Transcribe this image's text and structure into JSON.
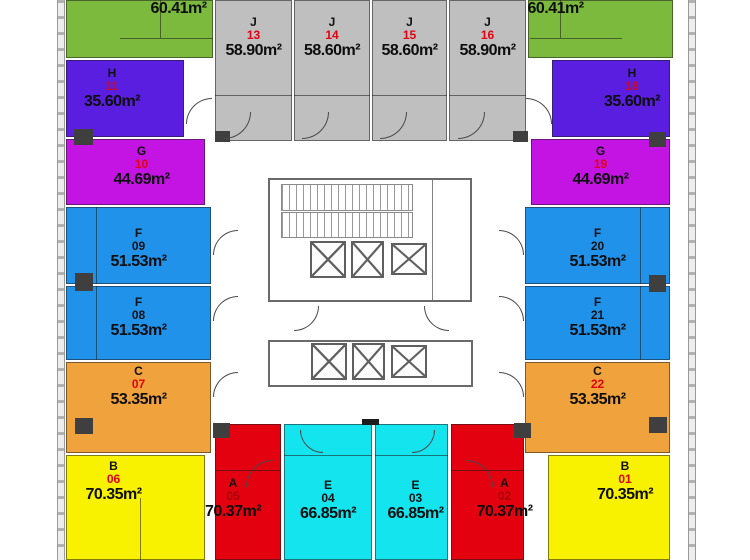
{
  "palette": {
    "green": "#7cba3d",
    "gray": "#bfbfbf",
    "purple": "#5a1ee0",
    "magenta": "#c414e4",
    "blue": "#2192ea",
    "orange": "#f0a23c",
    "yellow": "#f8f200",
    "red": "#e3000f",
    "cyan": "#14e4ee",
    "wall": "#5a5a5a",
    "shaft": "#3f3f3f"
  },
  "units": {
    "u12": {
      "letter": "",
      "number": "12",
      "area": "60.41m²",
      "color": "#7cba3d",
      "num_color": "#e30010"
    },
    "j13": {
      "letter": "J",
      "number": "13",
      "area": "58.90m²",
      "color": "#bfbfbf",
      "num_color": "#e30010"
    },
    "j14": {
      "letter": "J",
      "number": "14",
      "area": "58.60m²",
      "color": "#bfbfbf",
      "num_color": "#e30010"
    },
    "j15": {
      "letter": "J",
      "number": "15",
      "area": "58.60m²",
      "color": "#bfbfbf",
      "num_color": "#e30010"
    },
    "j16": {
      "letter": "J",
      "number": "16",
      "area": "58.90m²",
      "color": "#bfbfbf",
      "num_color": "#e30010"
    },
    "u17": {
      "letter": "",
      "number": "17",
      "area": "60.41m²",
      "color": "#7cba3d",
      "num_color": "#e30010"
    },
    "h11": {
      "letter": "H",
      "number": "11",
      "area": "35.60m²",
      "color": "#5a1ee0",
      "num_color": "#cf0a18"
    },
    "h18": {
      "letter": "H",
      "number": "18",
      "area": "35.60m²",
      "color": "#5a1ee0",
      "num_color": "#cf0a18"
    },
    "g10": {
      "letter": "G",
      "number": "10",
      "area": "44.69m²",
      "color": "#c414e4",
      "num_color": "#e30010"
    },
    "g19": {
      "letter": "G",
      "number": "19",
      "area": "44.69m²",
      "color": "#c414e4",
      "num_color": "#e30010"
    },
    "f09": {
      "letter": "F",
      "number": "09",
      "area": "51.53m²",
      "color": "#2192ea",
      "num_color": "#111111"
    },
    "f20": {
      "letter": "F",
      "number": "20",
      "area": "51.53m²",
      "color": "#2192ea",
      "num_color": "#111111"
    },
    "f08": {
      "letter": "F",
      "number": "08",
      "area": "51.53m²",
      "color": "#2192ea",
      "num_color": "#111111"
    },
    "f21": {
      "letter": "F",
      "number": "21",
      "area": "51.53m²",
      "color": "#2192ea",
      "num_color": "#111111"
    },
    "c07": {
      "letter": "C",
      "number": "07",
      "area": "53.35m²",
      "color": "#f0a23c",
      "num_color": "#e30010"
    },
    "c22": {
      "letter": "C",
      "number": "22",
      "area": "53.35m²",
      "color": "#f0a23c",
      "num_color": "#e30010"
    },
    "b06": {
      "letter": "B",
      "number": "06",
      "area": "70.35m²",
      "color": "#f8f200",
      "num_color": "#e30010"
    },
    "b01": {
      "letter": "B",
      "number": "01",
      "area": "70.35m²",
      "color": "#f8f200",
      "num_color": "#e30010"
    },
    "a05": {
      "letter": "A",
      "number": "05",
      "area": "70.37m²",
      "color": "#e3000f",
      "num_color": "#a80008"
    },
    "a02": {
      "letter": "A",
      "number": "02",
      "area": "70.37m²",
      "color": "#e3000f",
      "num_color": "#a80008"
    },
    "e04": {
      "letter": "E",
      "number": "04",
      "area": "66.85m²",
      "color": "#14e4ee",
      "num_color": "#111111"
    },
    "e03": {
      "letter": "E",
      "number": "03",
      "area": "66.85m²",
      "color": "#14e4ee",
      "num_color": "#111111"
    }
  }
}
